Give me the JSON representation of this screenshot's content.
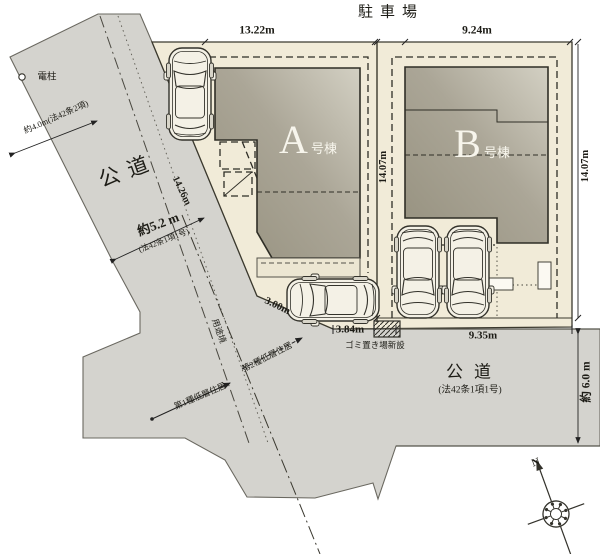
{
  "header": {
    "parking_title": "駐車場"
  },
  "lots": {
    "a": {
      "letter": "A",
      "suffix": "号棟",
      "top_dim": "13.22m",
      "side_dim": "14.07m"
    },
    "b": {
      "letter": "B",
      "suffix": "号棟",
      "top_dim": "9.24m",
      "side_dim": "14.07m"
    }
  },
  "roads": {
    "left": {
      "name": "公道",
      "width": "約5.2 m",
      "width_law": "(法42条1項1号)",
      "upper_width": "約4.0m(法42条2項)"
    },
    "bottom": {
      "name": "公道",
      "law": "(法42条1項1号)",
      "width": "約 6.0 m"
    }
  },
  "dims": {
    "lot_a_side_road": "14.26m",
    "corner_cut": "3.00m",
    "frontage_center": "3.84m",
    "frontage_b": "9.35m"
  },
  "annotations": {
    "utility_pole": "電柱",
    "garbage": "ゴミ置き場新設",
    "zoning_boundary": "用途境",
    "zone_first": "第1種低層住居",
    "zone_second": "第2種低層住居",
    "compass_north": "N"
  },
  "colors": {
    "road": "#d4d3ce",
    "lot": "#f1ebd8",
    "building_dark": "#9b9686",
    "building_light": "#cdcabc",
    "outline": "#3b392e"
  }
}
